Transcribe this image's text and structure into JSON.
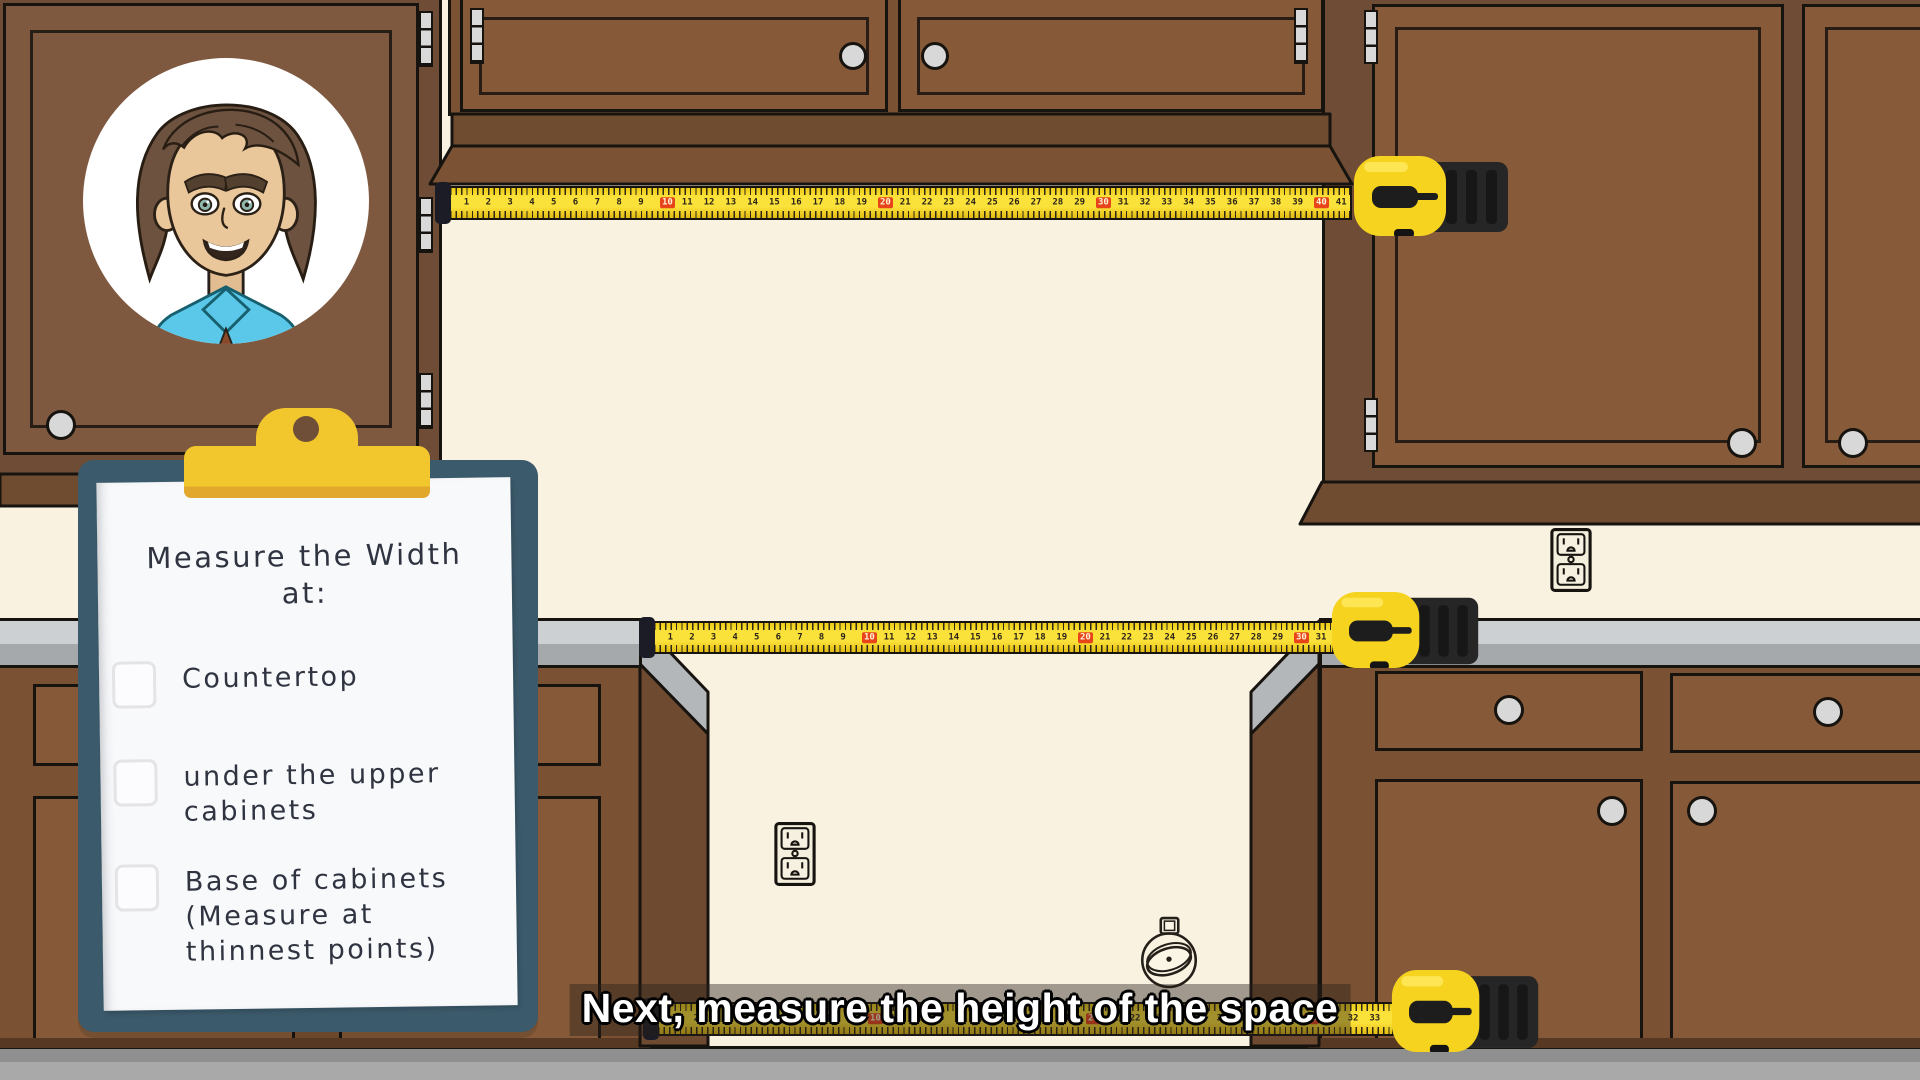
{
  "caption": {
    "text": "Next, measure the height of the space"
  },
  "clipboard": {
    "title_lines": [
      "Measure the Width",
      "at:"
    ],
    "items": [
      {
        "label_lines": [
          "Countertop"
        ],
        "checked": false
      },
      {
        "label_lines": [
          "under the upper",
          "cabinets"
        ],
        "checked": false
      },
      {
        "label_lines": [
          "Base of cabinets",
          "(Measure at",
          "thinnest points)"
        ],
        "checked": false
      }
    ]
  },
  "tapes": [
    {
      "name": "upper-wall",
      "x": 448,
      "y": 186,
      "length": 904,
      "band_h": 34,
      "body": {
        "x": 1352,
        "y": 156,
        "w": 160,
        "h": 80
      },
      "numbers": {
        "start": 1,
        "end": 41,
        "spacing": 21.8,
        "red_every": 10
      }
    },
    {
      "name": "countertop",
      "x": 652,
      "y": 621,
      "length": 682,
      "band_h": 33,
      "body": {
        "x": 1330,
        "y": 592,
        "w": 152,
        "h": 76
      },
      "numbers": {
        "start": 1,
        "end": 31,
        "spacing": 21.6,
        "red_every": 10
      }
    },
    {
      "name": "cabinet-base",
      "x": 656,
      "y": 1002,
      "length": 738,
      "band_h": 34,
      "body": {
        "x": 1390,
        "y": 970,
        "w": 152,
        "h": 82
      },
      "numbers": {
        "start": 1,
        "end": 33,
        "spacing": 21.8,
        "red_every": 10
      }
    }
  ],
  "colors": {
    "wall": "#FAF2E1",
    "floor": "#A9A9A9",
    "cabinet_brown": "#7E5940",
    "cabinet_frame": "#6F4C35",
    "counter_gray": "#CDD0D2",
    "tape_yellow": "#FBE23B",
    "tape_red_marker": "#E8441A",
    "clipboard_teal": "#3B5A6B",
    "clip_yellow": "#F2C72E",
    "caption_text": "#FFFFFF",
    "ink": "#2F3440"
  },
  "avatar": {
    "description": "cartoon man with brown hair and cyan collared shirt"
  }
}
